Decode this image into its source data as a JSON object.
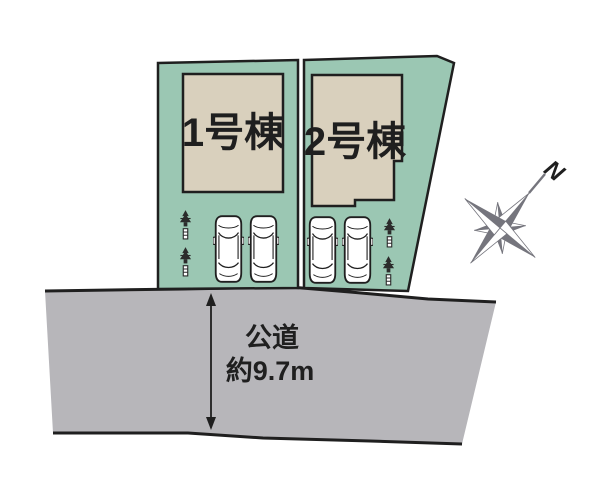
{
  "lots": [
    {
      "label": "1号棟"
    },
    {
      "label": "2号棟"
    }
  ],
  "road": {
    "name": "公道",
    "width": "約9.7m"
  },
  "compass": {
    "north_label": "N"
  },
  "icons": {
    "car": "car-top-view-icon",
    "tree": "tree-icon",
    "compass": "compass-rose-icon",
    "dimension_arrow": "road-width-arrow"
  },
  "colors": {
    "lot_fill": "#9bc7b3",
    "building_fill": "#d9d0bd",
    "road_fill": "#b7b6ba",
    "outline": "#1f1f1f",
    "compass_gray": "#75757d",
    "label_text": "#1f1f1f"
  }
}
